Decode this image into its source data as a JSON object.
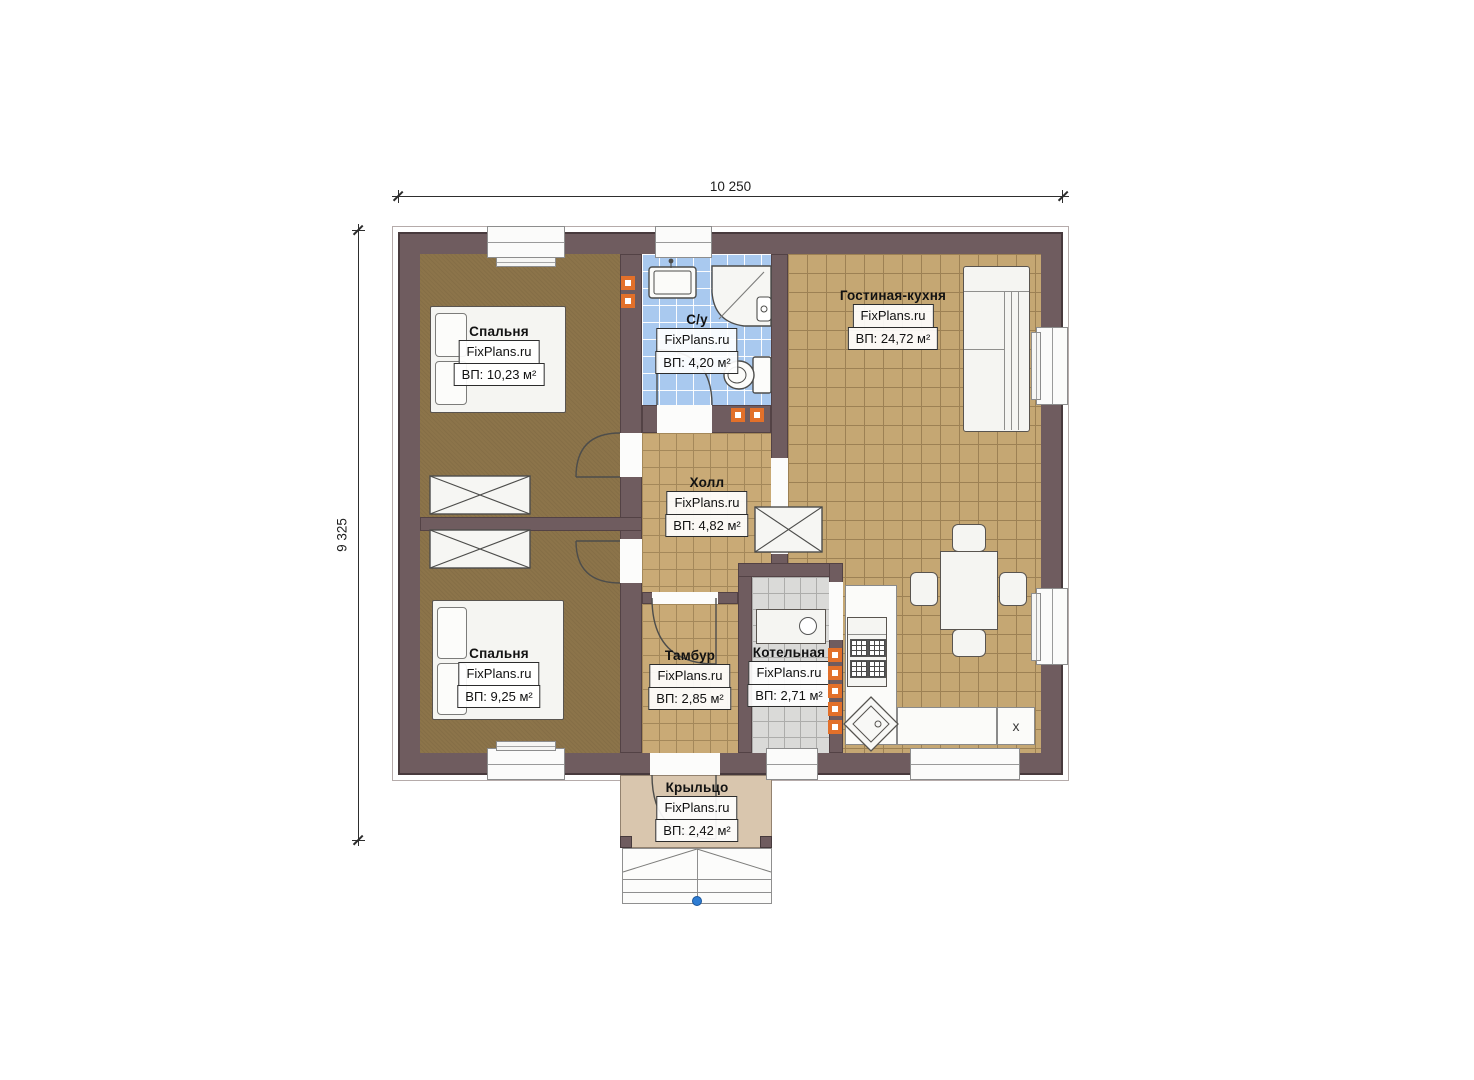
{
  "dimensions": {
    "width_mm": "10 250",
    "height_mm": "9 325"
  },
  "rooms": [
    {
      "id": "bedroom-1",
      "name": "Спальня",
      "watermark": "FixPlans.ru",
      "area": "ВП: 10,23 м²"
    },
    {
      "id": "bathroom",
      "name": "С/у",
      "watermark": "FixPlans.ru",
      "area": "ВП: 4,20 м²"
    },
    {
      "id": "living-kitchen",
      "name": "Гостиная-кухня",
      "watermark": "FixPlans.ru",
      "area": "ВП: 24,72 м²"
    },
    {
      "id": "hall",
      "name": "Холл",
      "watermark": "FixPlans.ru",
      "area": "ВП: 4,82 м²"
    },
    {
      "id": "bedroom-2",
      "name": "Спальня",
      "watermark": "FixPlans.ru",
      "area": "ВП: 9,25 м²"
    },
    {
      "id": "vestibule",
      "name": "Тамбур",
      "watermark": "FixPlans.ru",
      "area": "ВП: 2,85 м²"
    },
    {
      "id": "boiler-room",
      "name": "Котельная",
      "watermark": "FixPlans.ru",
      "area": "ВП: 2,71 м²"
    },
    {
      "id": "porch",
      "name": "Крыльцо",
      "watermark": "FixPlans.ru",
      "area": "ВП: 2,42 м²"
    }
  ],
  "kitchen": {
    "counter_marker": "x"
  },
  "colors": {
    "wall": "#6f5c5f",
    "carpet_floor": "#8c744a",
    "tile_tan": "#c9aa76",
    "tile_blue": "#a9c9ef",
    "tile_gray": "#dadad8",
    "porch_floor": "#d9c6ae",
    "vent_accent": "#e2702a",
    "reference_dot": "#2f7dd3"
  }
}
